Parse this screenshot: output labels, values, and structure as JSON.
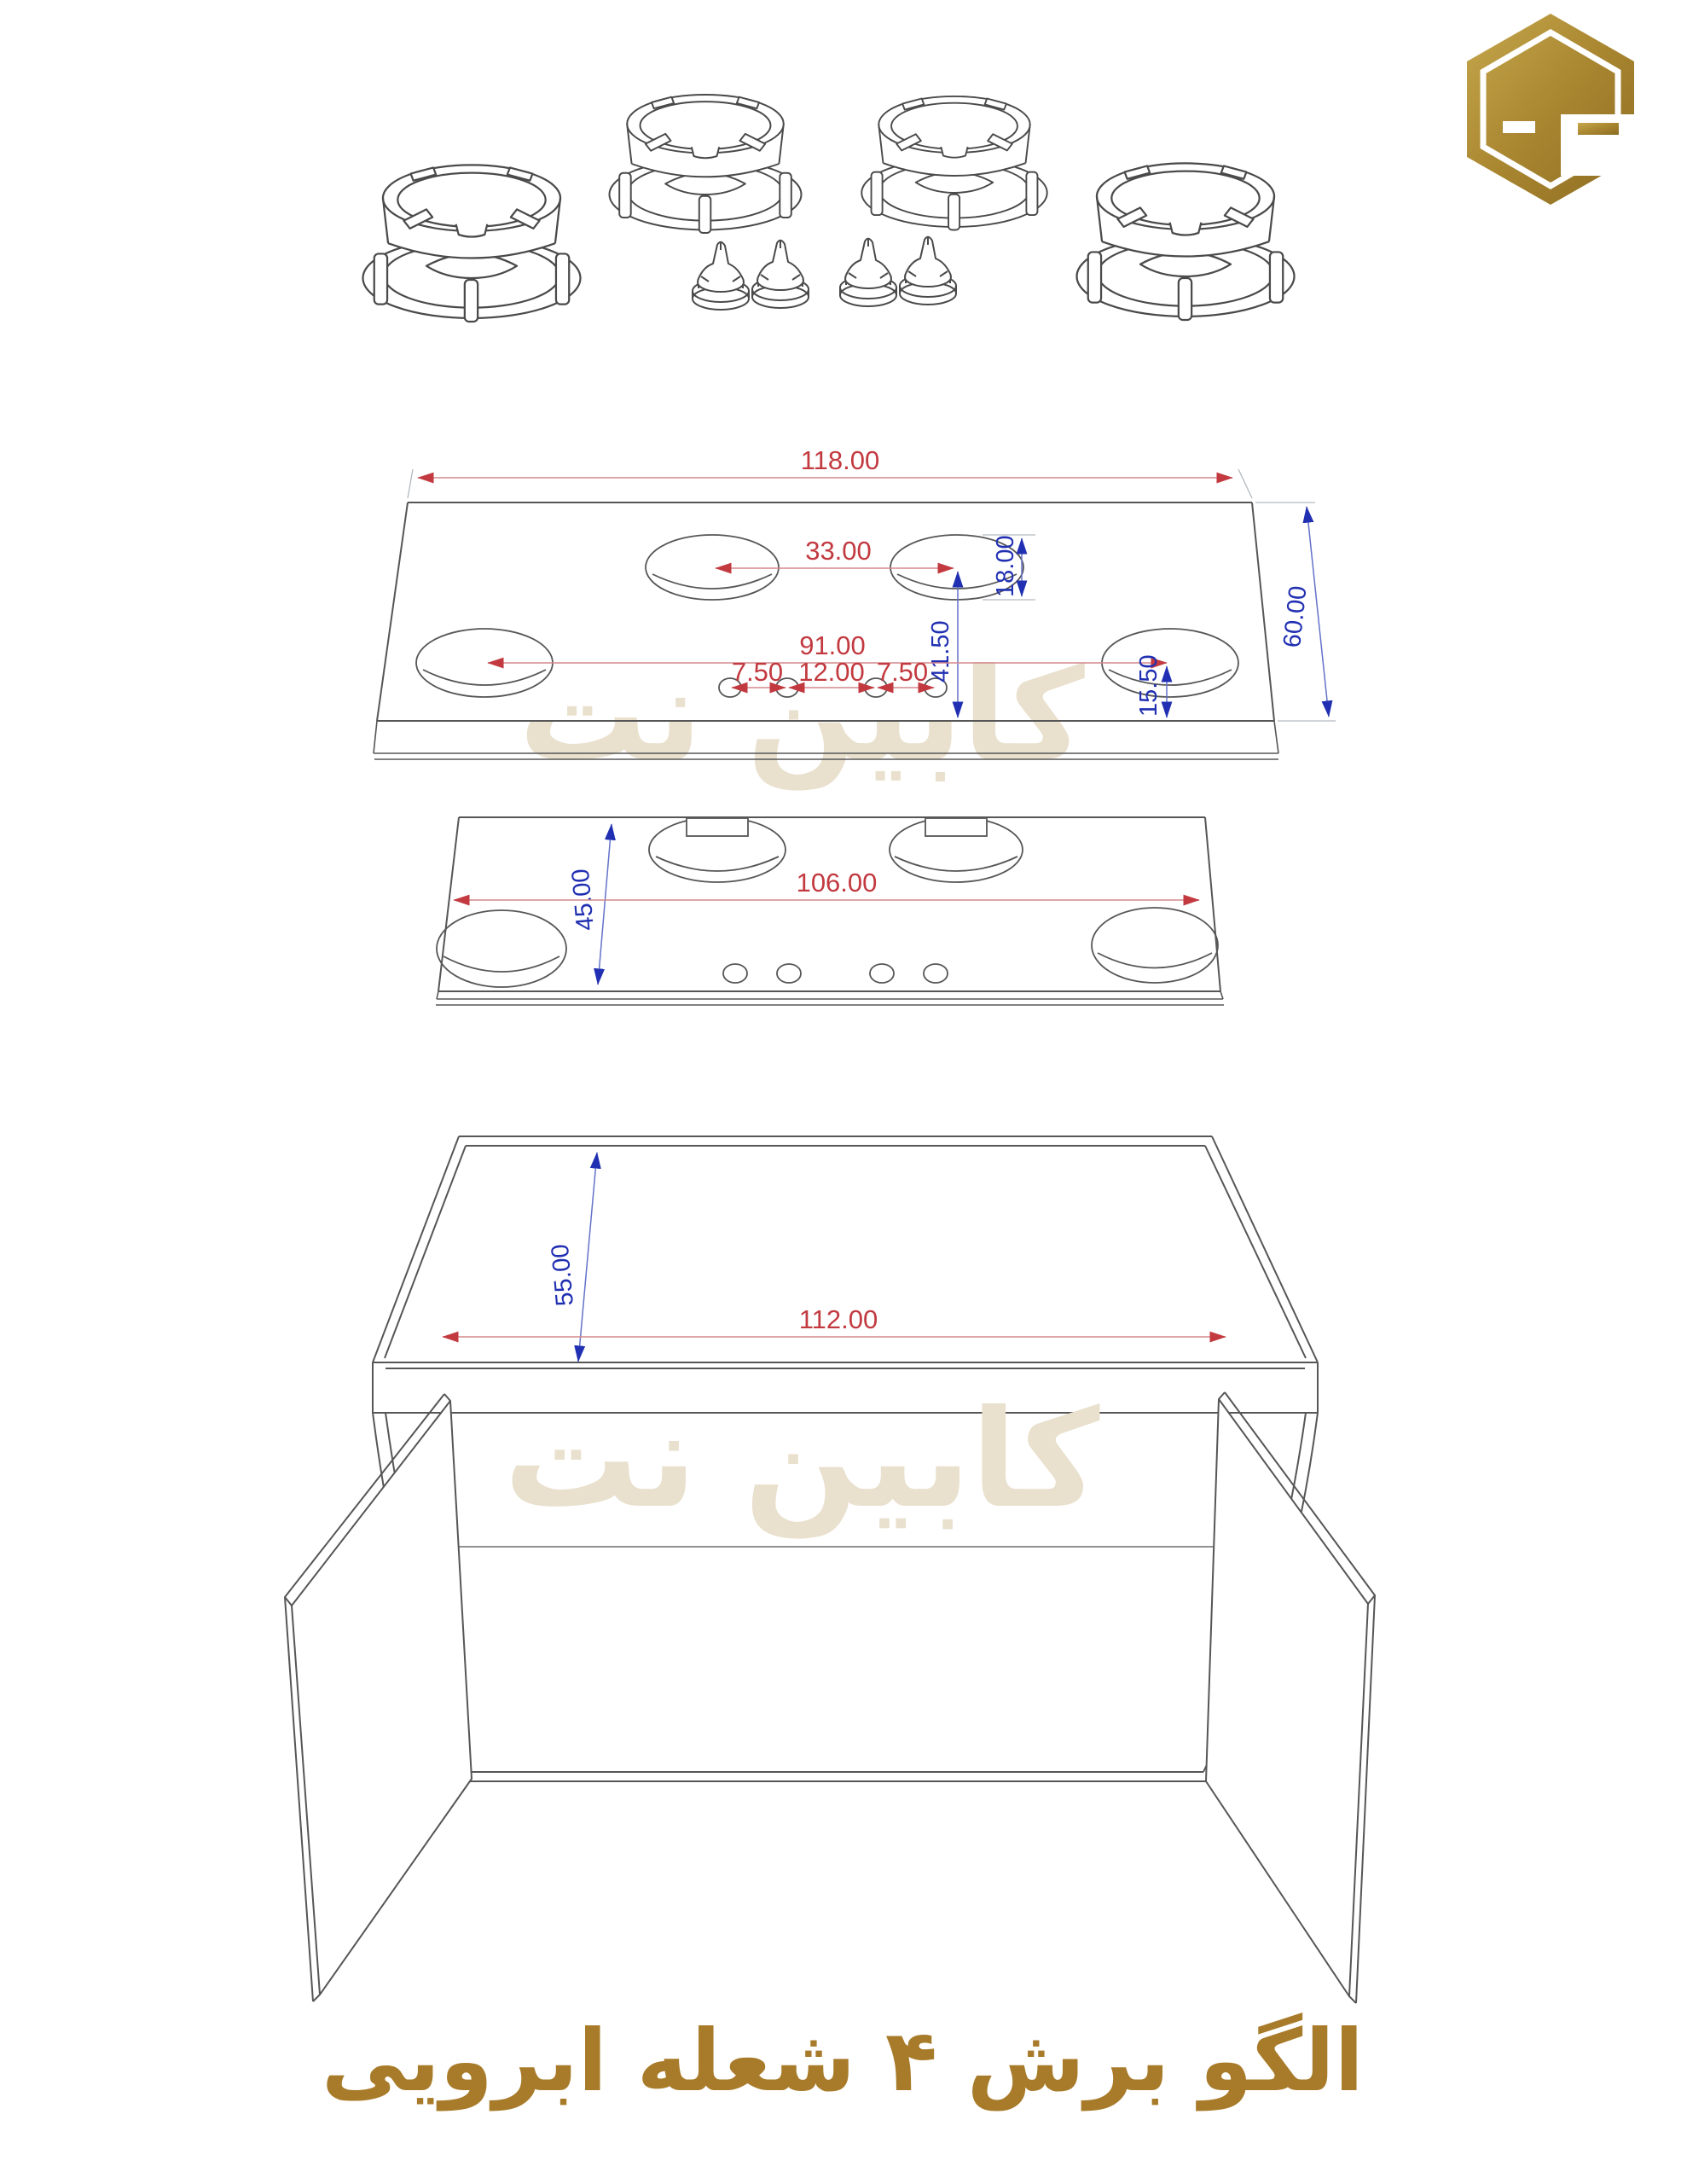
{
  "title": {
    "text": "الگو برش ۴ شعله ابرویی"
  },
  "watermark": {
    "text": "کابین نت"
  },
  "logo": {
    "icon": "hexagon-c-logo"
  },
  "colors": {
    "dim_red": "#c23a40",
    "dim_red_line": "#d4888c",
    "dim_blue": "#2130b2",
    "dim_blue_line": "#6372c9",
    "outline": "#565656",
    "watermark": "#e9e0cd",
    "title_gold": "#a87b2a",
    "logo_gold": "#ab8a33"
  },
  "top_panel": {
    "dim_width": "118.00",
    "dim_depth": "60.00",
    "dim_hole_gap": "33.00",
    "dim_hole_v": "18.00",
    "dim_row_v": "41.50",
    "dim_holes_span": "91.00",
    "dim_knob_a": "7.50",
    "dim_knob_b": "12.00",
    "dim_knob_c": "7.50",
    "dim_edge_v": "15.50"
  },
  "mid_panel": {
    "dim_width": "106.00",
    "dim_depth": "45.00"
  },
  "cabinet": {
    "dim_width": "112.00",
    "dim_top_depth": "55.00"
  }
}
